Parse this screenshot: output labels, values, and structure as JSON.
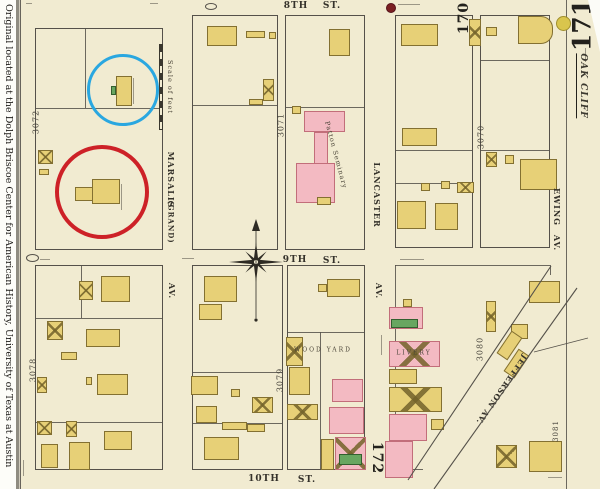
{
  "sidebar": {
    "credit": "Original located at the Dolph Briscoe Center for American History, University of Texas at Austin"
  },
  "sheet": {
    "page_number": "171",
    "adjacent_sheet_top": "170",
    "adjacent_sheet_bottom": "172",
    "district": "OAK CLIFF",
    "scale_label": "Scale of feet"
  },
  "streets": {
    "eighth": {
      "name": "8TH",
      "suffix": "ST."
    },
    "ninth": {
      "name": "9TH",
      "suffix": "ST."
    },
    "tenth": {
      "name": "10TH",
      "suffix": "ST."
    },
    "marsalis": {
      "name": "MARSALIS",
      "alt": "(GRAND)",
      "suffix": "AV."
    },
    "lancaster": {
      "name": "LANCASTER",
      "suffix": "AV."
    },
    "ewing": {
      "name": "EWING",
      "suffix": "AV."
    },
    "jefferson": {
      "name": "JEFFERSON AV."
    }
  },
  "blocks": {
    "b3072": "3072",
    "b3071": "3071",
    "b3070": "3070",
    "b3078": "3078",
    "b3079": "3079",
    "b3080": "3080",
    "b3081": "3081"
  },
  "labels": {
    "patton_seminary": "Patton Seminary",
    "wood_yard": "Wood Yard",
    "livery": "Livery"
  },
  "annotations": {
    "blue_circle_color": "#2aa7e0",
    "red_circle_color": "#cd2127"
  },
  "colors": {
    "paper": "#f1ebd1",
    "building_yellow": "#e7d077",
    "building_pink": "#f3bac2",
    "building_green": "#68a660",
    "map_line": "#55514a"
  },
  "geometry": {
    "blocks": [
      [
        35,
        28,
        128,
        222
      ],
      [
        192,
        15,
        86,
        235
      ],
      [
        285,
        15,
        80,
        235
      ],
      [
        395,
        15,
        78,
        233
      ],
      [
        480,
        15,
        70,
        233
      ],
      [
        35,
        265,
        128,
        205
      ],
      [
        192,
        265,
        91,
        205
      ],
      [
        287,
        265,
        78,
        205
      ]
    ],
    "lines": [
      [
        85,
        28,
        1,
        80
      ],
      [
        35,
        108,
        128,
        1
      ],
      [
        192,
        105,
        86,
        1
      ],
      [
        285,
        107,
        80,
        1
      ],
      [
        395,
        150,
        78,
        1
      ],
      [
        395,
        183,
        78,
        1
      ],
      [
        480,
        60,
        70,
        1
      ],
      [
        480,
        150,
        70,
        1
      ],
      [
        35,
        318,
        128,
        1
      ],
      [
        35,
        422,
        128,
        1
      ],
      [
        81,
        265,
        1,
        53
      ],
      [
        192,
        372,
        91,
        1
      ],
      [
        192,
        423,
        91,
        1
      ],
      [
        287,
        332,
        78,
        1
      ],
      [
        320,
        332,
        1,
        138
      ],
      [
        395,
        265,
        1,
        205
      ],
      [
        395,
        265,
        155,
        1
      ],
      [
        550,
        265,
        1,
        10
      ],
      [
        395,
        469,
        28,
        1
      ],
      [
        566,
        0,
        1,
        489
      ],
      [
        20,
        0,
        1,
        489
      ]
    ],
    "ellipses": [
      [
        205,
        3,
        12,
        7
      ],
      [
        26,
        254,
        13,
        8
      ]
    ],
    "micro": [
      [
        398,
        4,
        22,
        1
      ],
      [
        133,
        78,
        1,
        26
      ],
      [
        121,
        184,
        1,
        26
      ],
      [
        400,
        259,
        24,
        1
      ],
      [
        381,
        335,
        1,
        20
      ],
      [
        40,
        259,
        10,
        1
      ],
      [
        23,
        460,
        1,
        16
      ],
      [
        548,
        477,
        14,
        1
      ],
      [
        182,
        258,
        12,
        1
      ],
      [
        585,
        48,
        1,
        14
      ],
      [
        150,
        3,
        8,
        1
      ],
      [
        26,
        3,
        6,
        1
      ]
    ]
  },
  "buildings": [
    [
      116,
      76,
      16,
      30,
      "y",
      ""
    ],
    [
      111,
      86,
      5,
      9,
      "g",
      ""
    ],
    [
      38,
      150,
      15,
      14,
      "y",
      "x"
    ],
    [
      39,
      169,
      10,
      6,
      "y",
      ""
    ],
    [
      92,
      179,
      28,
      25,
      "y",
      ""
    ],
    [
      75,
      187,
      18,
      14,
      "y",
      ""
    ],
    [
      207,
      26,
      30,
      20,
      "y",
      ""
    ],
    [
      246,
      31,
      19,
      7,
      "y",
      ""
    ],
    [
      269,
      32,
      7,
      7,
      "y",
      ""
    ],
    [
      263,
      79,
      11,
      22,
      "y",
      "x"
    ],
    [
      249,
      99,
      14,
      6,
      "y",
      ""
    ],
    [
      329,
      29,
      21,
      27,
      "y",
      ""
    ],
    [
      292,
      106,
      9,
      8,
      "y",
      ""
    ],
    [
      304,
      111,
      41,
      21,
      "p",
      ""
    ],
    [
      314,
      132,
      14,
      32,
      "p",
      ""
    ],
    [
      296,
      163,
      39,
      40,
      "p",
      ""
    ],
    [
      317,
      197,
      14,
      8,
      "y",
      ""
    ],
    [
      401,
      24,
      37,
      22,
      "y",
      ""
    ],
    [
      402,
      128,
      35,
      18,
      "y",
      ""
    ],
    [
      421,
      183,
      9,
      8,
      "y",
      ""
    ],
    [
      441,
      181,
      9,
      8,
      "y",
      ""
    ],
    [
      457,
      182,
      17,
      11,
      "y",
      "x"
    ],
    [
      397,
      201,
      29,
      28,
      "y",
      ""
    ],
    [
      435,
      203,
      23,
      27,
      "y",
      ""
    ],
    [
      469,
      19,
      12,
      27,
      "y",
      "x"
    ],
    [
      486,
      27,
      11,
      9,
      "y",
      ""
    ],
    [
      518,
      16,
      35,
      28,
      "y",
      "rr"
    ],
    [
      486,
      152,
      11,
      15,
      "y",
      "x"
    ],
    [
      505,
      155,
      9,
      9,
      "y",
      ""
    ],
    [
      520,
      159,
      37,
      31,
      "y",
      ""
    ],
    [
      529,
      281,
      31,
      22,
      "y",
      ""
    ],
    [
      486,
      301,
      10,
      31,
      "y",
      "x"
    ],
    [
      511,
      324,
      17,
      15,
      "y",
      ""
    ],
    [
      496,
      339,
      27,
      13,
      "y",
      "",
      -56
    ],
    [
      503,
      357,
      27,
      13,
      "y",
      "",
      -56
    ],
    [
      403,
      299,
      9,
      8,
      "y",
      ""
    ],
    [
      389,
      307,
      34,
      22,
      "p",
      ""
    ],
    [
      391,
      319,
      27,
      9,
      "g",
      ""
    ],
    [
      389,
      341,
      51,
      26,
      "p",
      "x"
    ],
    [
      389,
      369,
      28,
      15,
      "y",
      ""
    ],
    [
      389,
      387,
      53,
      25,
      "y",
      "x"
    ],
    [
      389,
      414,
      38,
      27,
      "p",
      ""
    ],
    [
      385,
      441,
      28,
      37,
      "p",
      ""
    ],
    [
      431,
      419,
      13,
      11,
      "y",
      ""
    ],
    [
      529,
      441,
      33,
      31,
      "y",
      ""
    ],
    [
      496,
      445,
      21,
      23,
      "y",
      "x"
    ],
    [
      204,
      276,
      33,
      26,
      "y",
      ""
    ],
    [
      199,
      304,
      23,
      16,
      "y",
      ""
    ],
    [
      191,
      376,
      27,
      19,
      "y",
      ""
    ],
    [
      196,
      406,
      21,
      17,
      "y",
      ""
    ],
    [
      252,
      397,
      21,
      16,
      "y",
      "x"
    ],
    [
      231,
      389,
      9,
      8,
      "y",
      ""
    ],
    [
      222,
      422,
      25,
      8,
      "y",
      ""
    ],
    [
      247,
      424,
      18,
      8,
      "y",
      ""
    ],
    [
      204,
      437,
      35,
      23,
      "y",
      ""
    ],
    [
      327,
      279,
      33,
      18,
      "y",
      ""
    ],
    [
      318,
      284,
      9,
      8,
      "y",
      ""
    ],
    [
      286,
      337,
      17,
      29,
      "y",
      "x"
    ],
    [
      289,
      367,
      21,
      28,
      "y",
      ""
    ],
    [
      287,
      404,
      31,
      16,
      "y",
      "x"
    ],
    [
      332,
      379,
      31,
      23,
      "p",
      ""
    ],
    [
      329,
      407,
      35,
      27,
      "p",
      ""
    ],
    [
      335,
      437,
      31,
      33,
      "p",
      "x"
    ],
    [
      339,
      454,
      23,
      11,
      "g",
      ""
    ],
    [
      321,
      439,
      13,
      31,
      "y",
      ""
    ],
    [
      101,
      276,
      29,
      26,
      "y",
      ""
    ],
    [
      79,
      281,
      14,
      19,
      "y",
      "x"
    ],
    [
      47,
      321,
      16,
      19,
      "y",
      "x"
    ],
    [
      86,
      329,
      34,
      18,
      "y",
      ""
    ],
    [
      61,
      352,
      16,
      8,
      "y",
      ""
    ],
    [
      37,
      377,
      10,
      16,
      "y",
      "x"
    ],
    [
      97,
      374,
      31,
      21,
      "y",
      ""
    ],
    [
      86,
      377,
      6,
      8,
      "y",
      ""
    ],
    [
      37,
      421,
      15,
      14,
      "y",
      "x"
    ],
    [
      66,
      421,
      11,
      16,
      "y",
      "x"
    ],
    [
      41,
      444,
      17,
      24,
      "y",
      ""
    ],
    [
      69,
      442,
      21,
      28,
      "y",
      ""
    ],
    [
      104,
      431,
      28,
      19,
      "y",
      ""
    ]
  ]
}
